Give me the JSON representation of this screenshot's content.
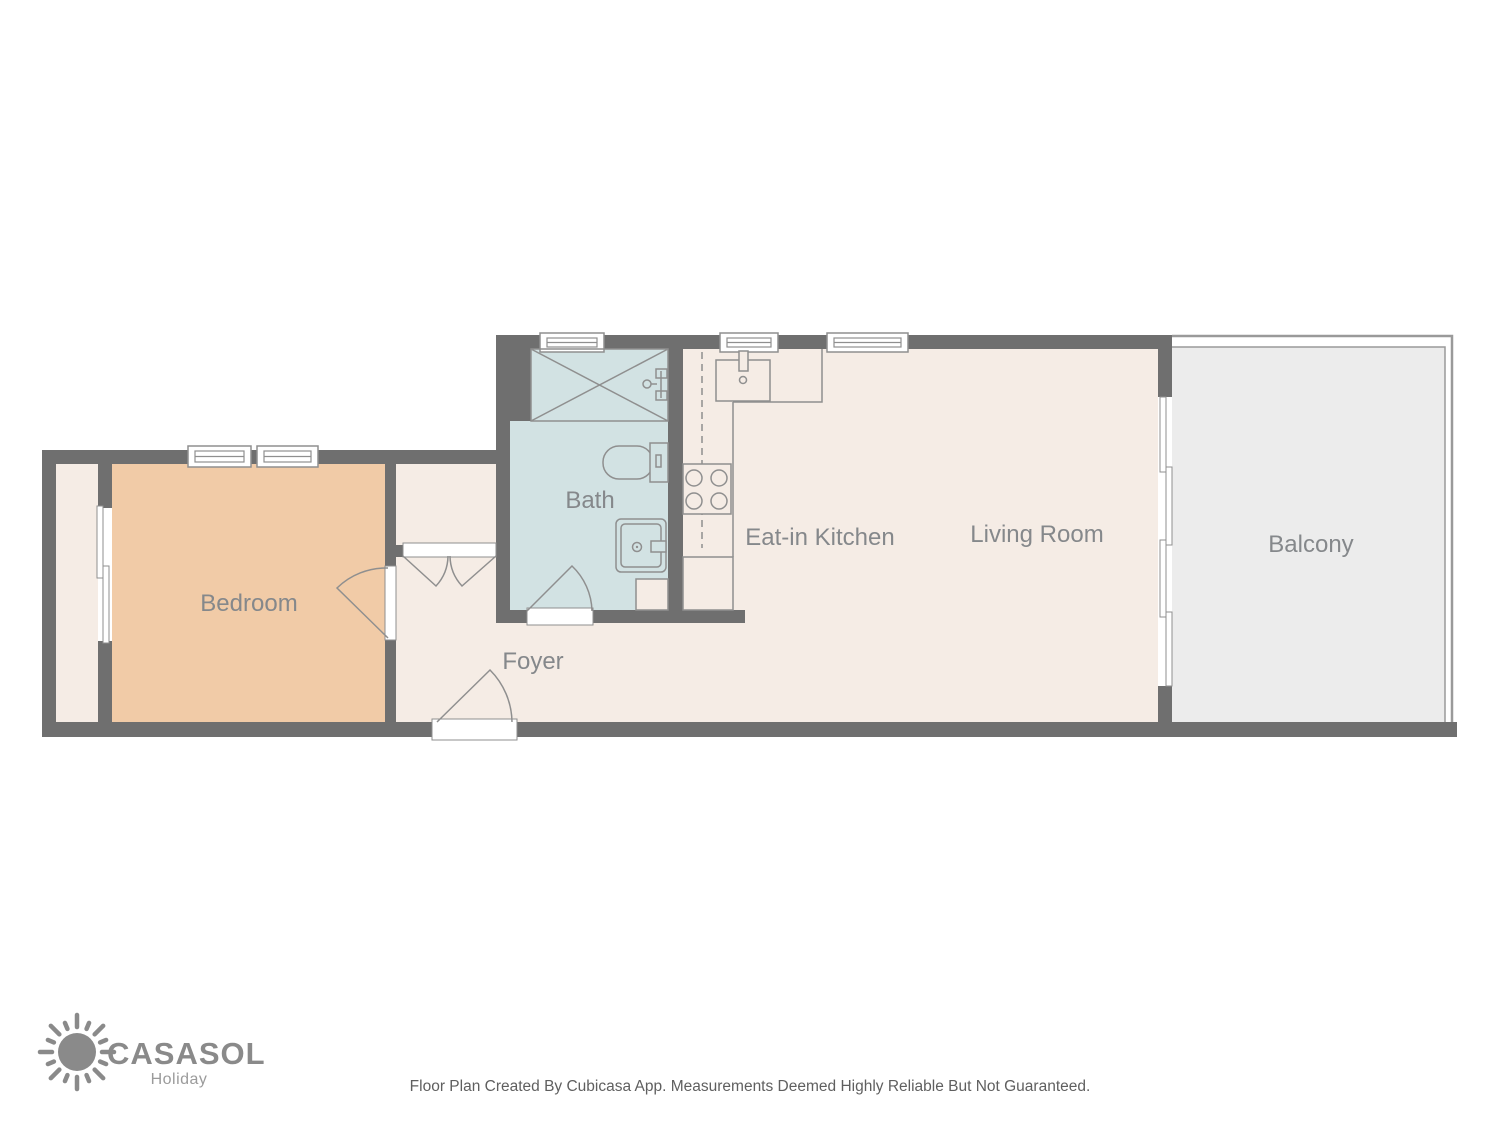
{
  "plan": {
    "rooms": [
      {
        "id": "bedroom",
        "label": "Bedroom"
      },
      {
        "id": "bath",
        "label": "Bath"
      },
      {
        "id": "foyer",
        "label": "Foyer"
      },
      {
        "id": "kitchen",
        "label": "Eat-in Kitchen"
      },
      {
        "id": "living",
        "label": "Living Room"
      },
      {
        "id": "balcony",
        "label": "Balcony"
      }
    ],
    "colors": {
      "wall": "#6f6f6f",
      "floor_default": "#f5ece5",
      "floor_bedroom": "#f1cba7",
      "floor_bath": "#d2e2e3",
      "floor_balcony": "#ececec",
      "fixture_outline": "#8f8f8f",
      "label_text": "#85888b"
    }
  },
  "logo": {
    "brand": "CASASOL",
    "tagline": "Holiday"
  },
  "footer": {
    "disclaimer": "Floor Plan Created By Cubicasa App. Measurements Deemed Highly Reliable But Not Guaranteed."
  }
}
